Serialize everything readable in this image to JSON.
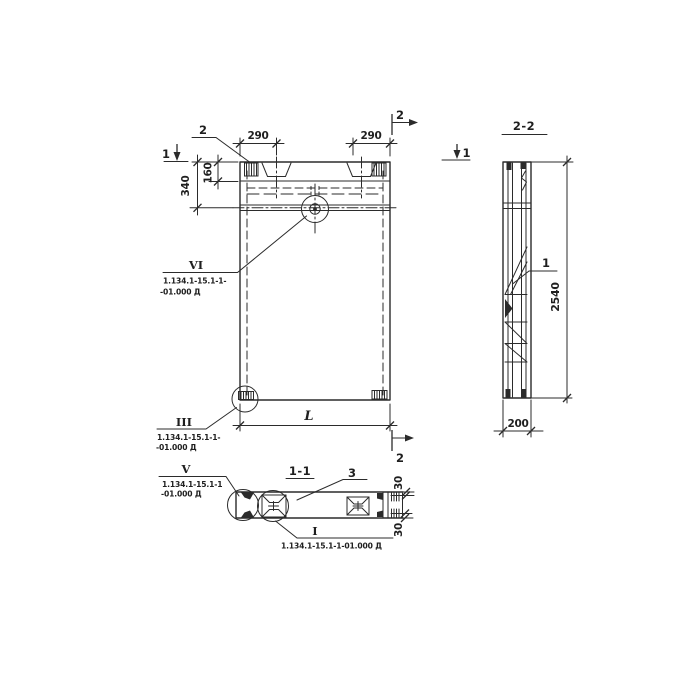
{
  "paper_color": "#ffffff",
  "ink_color": "#2b2b2b",
  "labels": {
    "section_2_2": "2-2",
    "section_1_1": "1-1",
    "mark_1_left": "1",
    "mark_1_right": "1",
    "mark_2_top": "2",
    "mark_2_bottom": "2",
    "callout_2": "2",
    "part_3": "3",
    "part_1": "1"
  },
  "dimensions": {
    "d290_left": "290",
    "d290_right": "290",
    "d340": "340",
    "d160": "160",
    "dL": "L",
    "d2540": "2540",
    "d200": "200",
    "d30_top": "30",
    "d30_bottom": "30"
  },
  "callouts": {
    "vi": {
      "label": "VI",
      "line1": "1.134.1-15.1-1-",
      "line2": "-01.000 Д"
    },
    "iii": {
      "label": "III",
      "line1": "1.134.1-15.1-1-",
      "line2": "-01.000 Д"
    },
    "v": {
      "label": "V",
      "line1": "1.134.1-15.1-1",
      "line2": "-01.000 Д"
    },
    "i": {
      "label": "I",
      "line1": "1.134.1-15.1-1-01.000 Д"
    }
  }
}
